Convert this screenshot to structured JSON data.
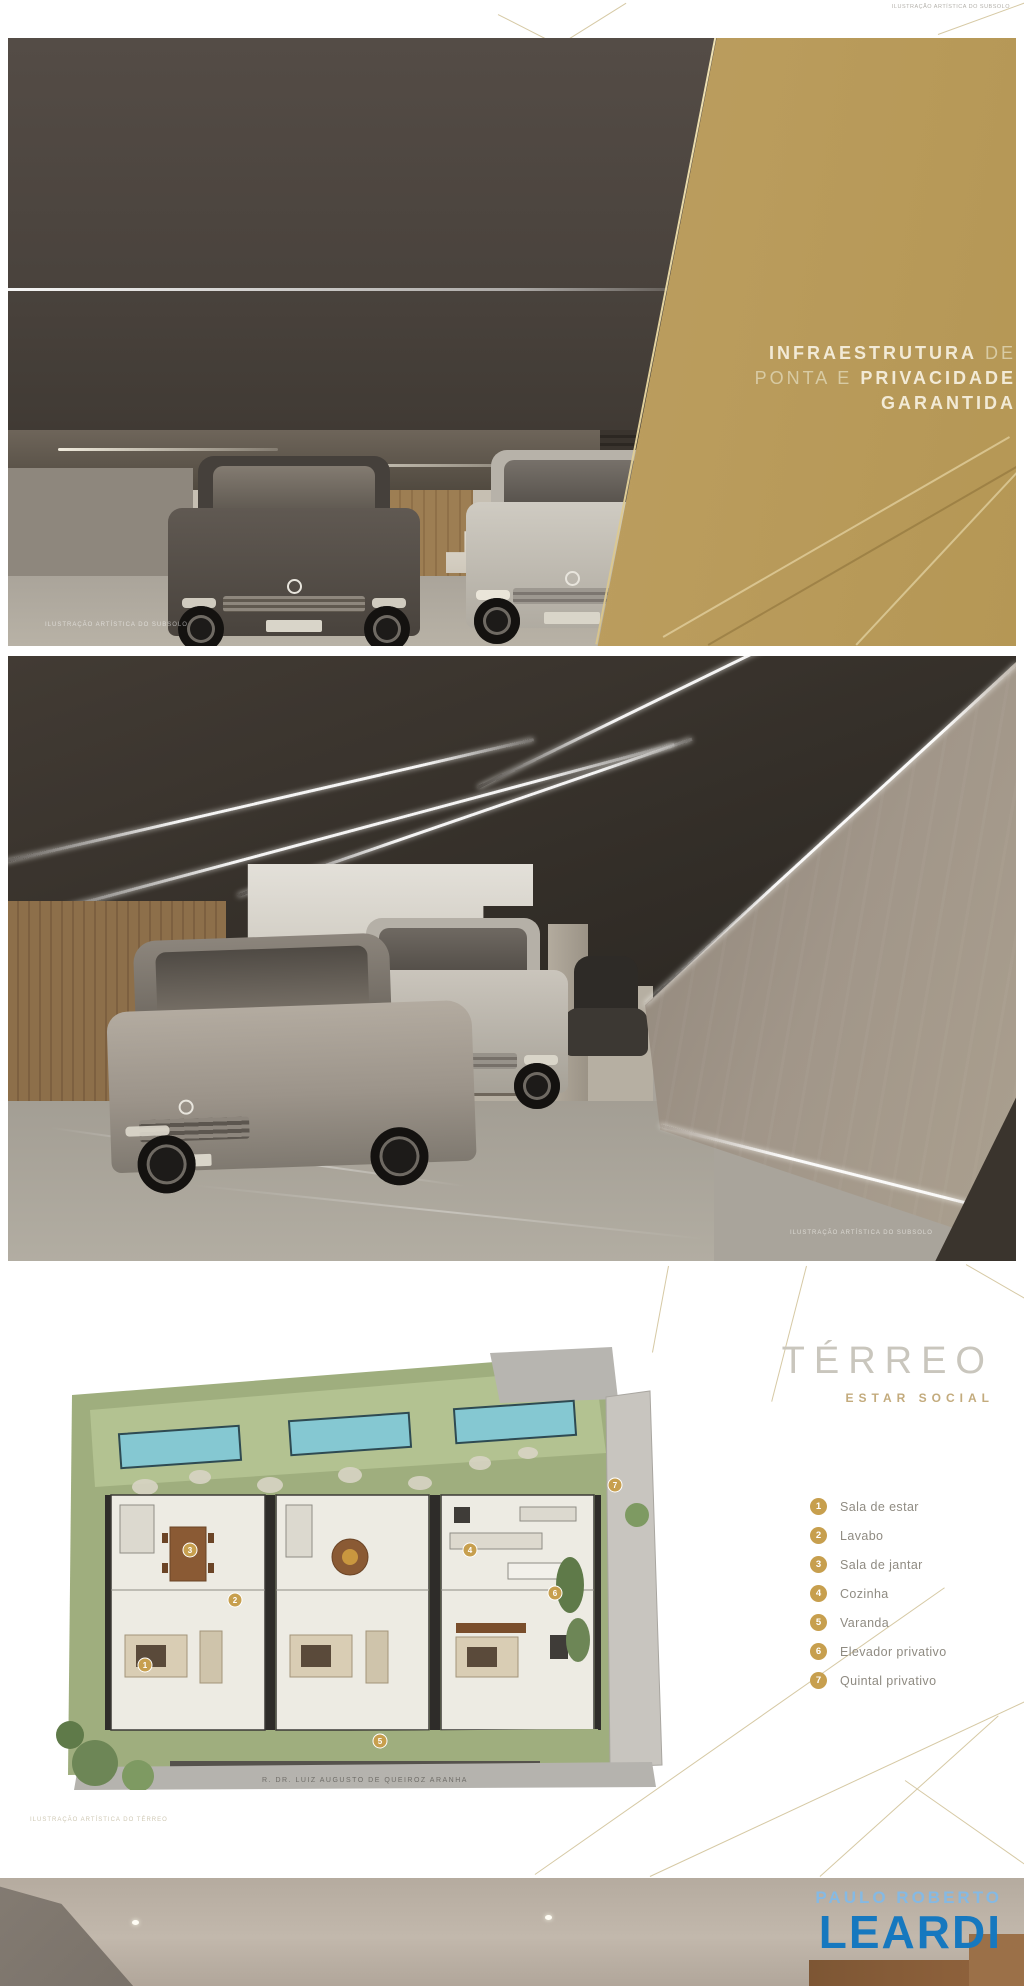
{
  "top_strip": {
    "caption": "ILUSTRAÇÃO ARTÍSTICA DO SUBSOLO"
  },
  "slide1": {
    "headline": {
      "line1_bold": "INFRAESTRUTURA",
      "line1_regular": " DE",
      "line2_regular": "PONTA E ",
      "line2_bold": "PRIVACIDADE",
      "line3_bold": "GARANTIDA"
    },
    "caption": "ILUSTRAÇÃO ARTÍSTICA DO SUBSOLO"
  },
  "slide2": {
    "caption": "ILUSTRAÇÃO ARTÍSTICA DO SUBSOLO"
  },
  "floorplan": {
    "title": "TÉRREO",
    "subtitle": "ESTAR SOCIAL",
    "legend": [
      {
        "number": "1",
        "label": "Sala de estar"
      },
      {
        "number": "2",
        "label": "Lavabo"
      },
      {
        "number": "3",
        "label": "Sala de jantar"
      },
      {
        "number": "4",
        "label": "Cozinha"
      },
      {
        "number": "5",
        "label": "Varanda"
      },
      {
        "number": "6",
        "label": "Elevador privativo"
      },
      {
        "number": "7",
        "label": "Quintal privativo"
      }
    ],
    "street_label": "R. DR. LUIZ AUGUSTO DE QUEIROZ ARANHA",
    "caption": "ILUSTRAÇÃO ARTÍSTICA DO TÉRREO"
  },
  "footer": {
    "brand_top": "PAULO ROBERTO",
    "brand_name": "LEARDI"
  },
  "colors": {
    "gold_panel": "#b5985a",
    "gold_lines": "#d6c9a4",
    "legend_circle": "#c79f4e",
    "brand_blue": "#1678bf",
    "brand_light_blue": "#85b9e3",
    "pool_teal": "#85c8d2",
    "site_green": "#9fae7e"
  }
}
